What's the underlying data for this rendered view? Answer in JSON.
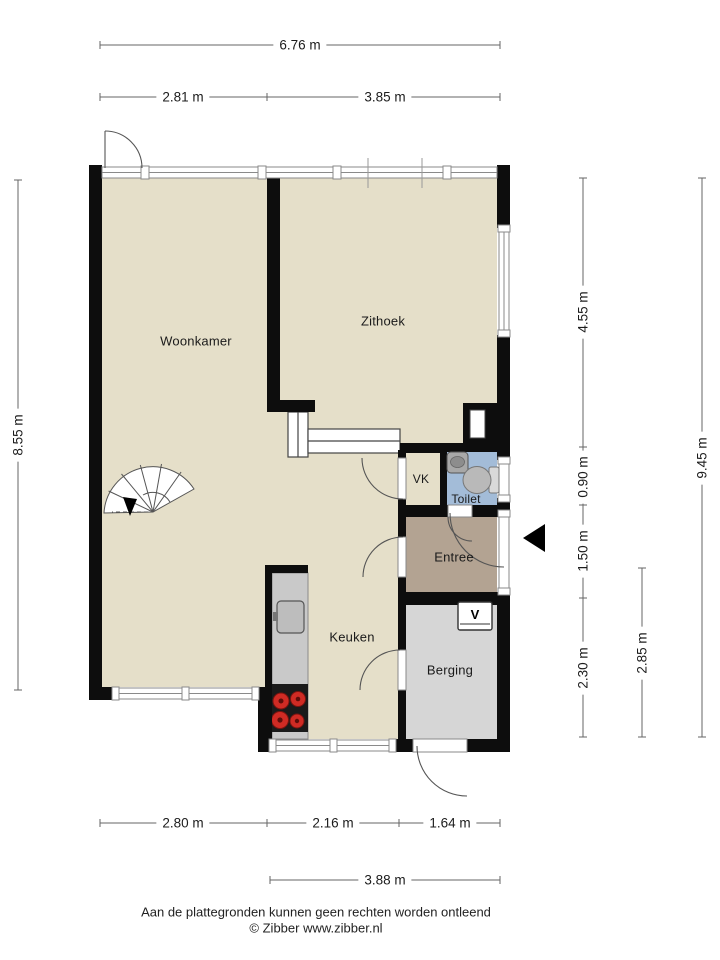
{
  "title": "Floor plan ground floor",
  "rooms": [
    {
      "id": "woonkamer",
      "label": "Woonkamer"
    },
    {
      "id": "zithoek",
      "label": "Zithoek"
    },
    {
      "id": "vk",
      "label": "VK"
    },
    {
      "id": "toilet",
      "label": "Toilet"
    },
    {
      "id": "entree",
      "label": "Entree"
    },
    {
      "id": "keuken",
      "label": "Keuken"
    },
    {
      "id": "berging",
      "label": "Berging"
    }
  ],
  "dimensions": {
    "top_total": "6.76 m",
    "top_left": "2.81 m",
    "top_right": "3.85 m",
    "left_total": "8.55 m",
    "right_seg1": "4.55 m",
    "right_seg2": "0.90 m",
    "right_seg3": "1.50 m",
    "right_seg4": "2.30 m",
    "right_mid": "2.85 m",
    "right_total": "9.45 m",
    "bottom_seg1": "2.80 m",
    "bottom_seg2": "2.16 m",
    "bottom_seg3": "1.64 m",
    "bottom_total": "3.88 m"
  },
  "fixtures": {
    "boiler_symbol": "V"
  },
  "footer": {
    "line1": "Aan de plattegronden kunnen geen rechten worden ontleend",
    "line2": "© Zibber www.zibber.nl"
  },
  "colors": {
    "wall": "#0d0d0d",
    "floor": "#e5dfc9",
    "entree_floor": "#b3a392",
    "berging_floor": "#d6d6d6",
    "toilet_floor": "#a3bcd8",
    "counter": "#c9c9c9",
    "burner": "#cf2b24",
    "dimension_line": "#666666"
  }
}
